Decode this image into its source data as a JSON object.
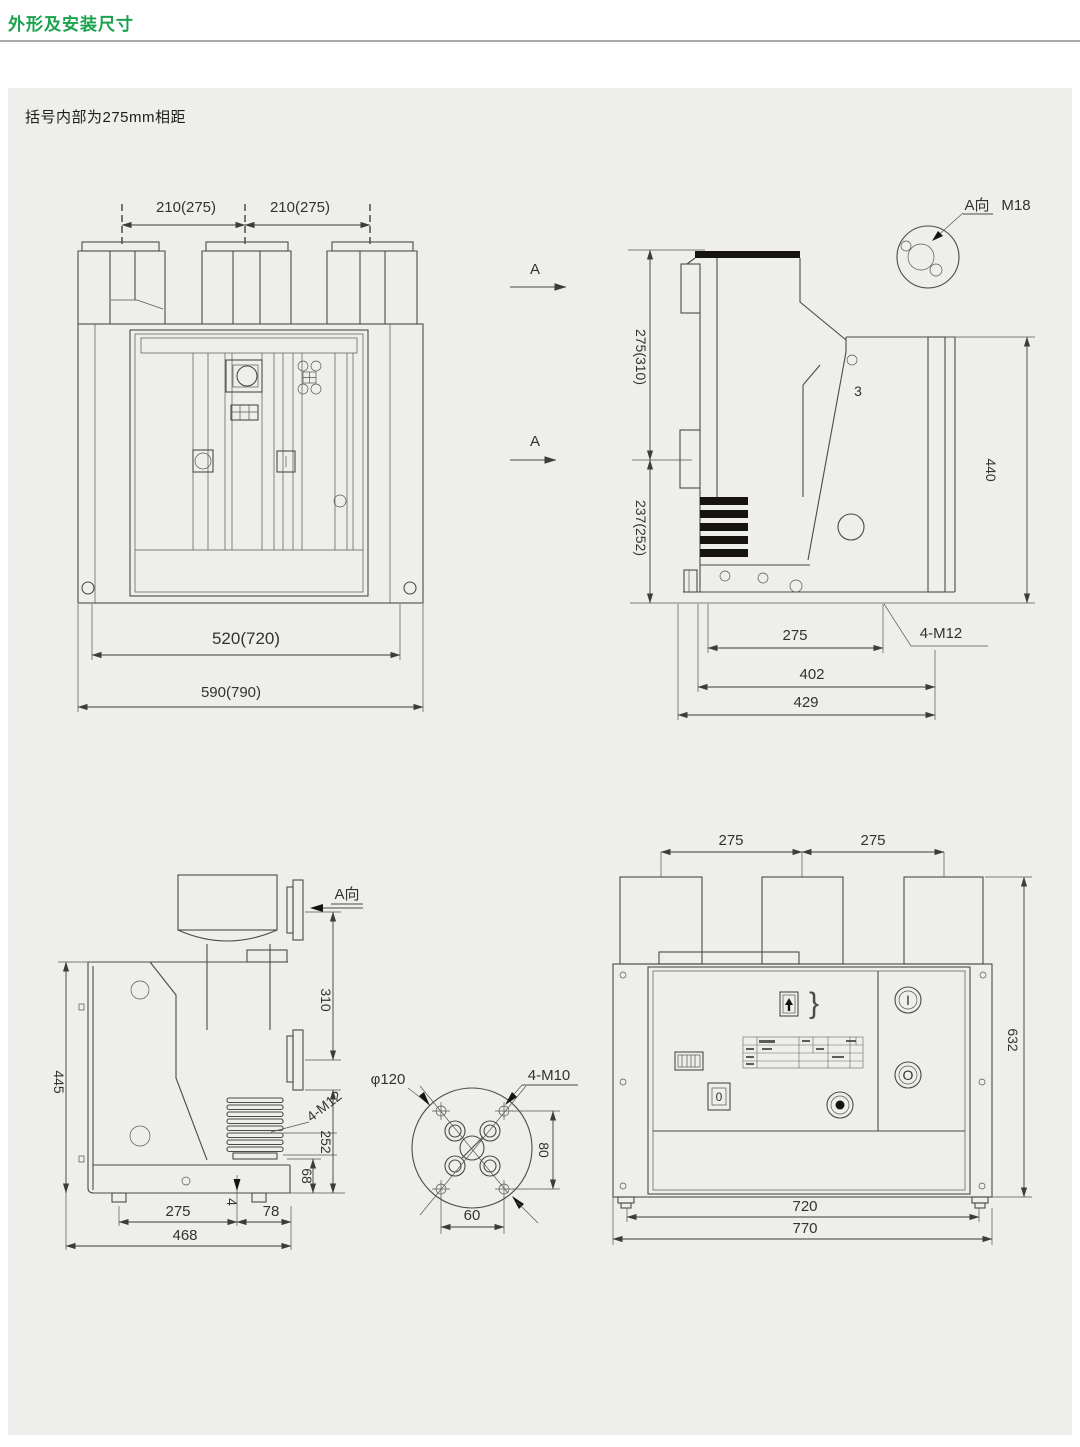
{
  "page": {
    "title": "外形及安装尺寸",
    "note": "括号内部为275mm相距"
  },
  "colors": {
    "accent_green": "#1aa24e",
    "panel_gray": "#eeeeec",
    "line": "#4e4a45"
  },
  "drawings": {
    "front_view": {
      "pole_pitch_left": "210(275)",
      "pole_pitch_right": "210(275)",
      "mount_width": "520(720)",
      "overall_width": "590(790)"
    },
    "side_view": {
      "section_label_top": "A",
      "section_label_bottom": "A",
      "detail_label": "A向",
      "detail_thread": "M18",
      "upper_height": "275(310)",
      "lower_height": "237(252)",
      "plate_height": "440",
      "callout": "3",
      "hole_span": "275",
      "depth_mid": "402",
      "depth_overall": "429",
      "bolt_spec": "4-M12"
    },
    "left_side_view": {
      "view_label": "A向",
      "flange_pitch": "310",
      "body_height": "445",
      "lower_span": "252",
      "foot_height": "68",
      "offset": "4",
      "foot_span": "275",
      "overhang": "78",
      "overall_depth": "468",
      "bolt_spec": "4-M12"
    },
    "flange_detail": {
      "diameter": "φ120",
      "bolt_spec": "4-M10",
      "hole_pitch_v": "80",
      "hole_pitch_h": "60"
    },
    "rear_view": {
      "pole_pitch_left": "275",
      "pole_pitch_right": "275",
      "overall_height": "632",
      "foot_span": "720",
      "overall_width": "770",
      "switch_label": "0",
      "close_button_label": "I",
      "open_button_label": "O",
      "bracket_mark": "}"
    }
  }
}
